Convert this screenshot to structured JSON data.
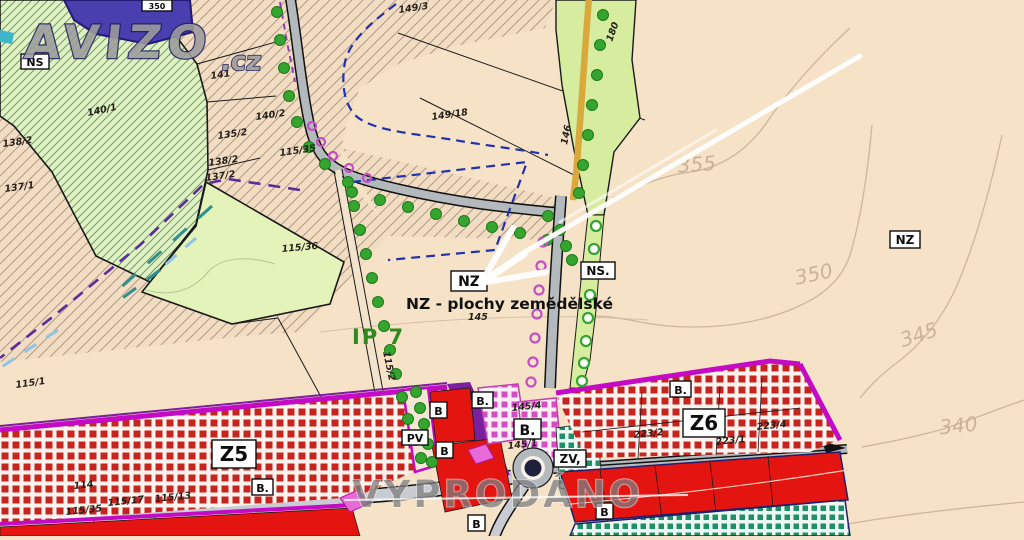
{
  "watermarks": {
    "brand": "AVIZO",
    "brand_suffix": ".cz",
    "sold": "VYPRODÁNO"
  },
  "callout": {
    "zone_code": "NZ",
    "text": "NZ - plochy zemědělské"
  },
  "map_labels": {
    "ns": "NS",
    "nz_right": "NZ",
    "ns_road": "NS.",
    "z5": "Z5",
    "z6": "Z6",
    "pv": "PV",
    "zv": "ZV,",
    "b": "B",
    "b_dot": "B.",
    "ip": "IP 7",
    "blue_parcel": "350"
  },
  "contour_labels": {
    "c355": "355",
    "c350": "350",
    "c345": "345",
    "c340": "340"
  },
  "parcels": [
    {
      "label": "140/1"
    },
    {
      "label": "141"
    },
    {
      "label": "140/2"
    },
    {
      "label": "135/2"
    },
    {
      "label": "149/3"
    },
    {
      "label": "149/18"
    },
    {
      "label": "146"
    },
    {
      "label": "180"
    },
    {
      "label": "138/2"
    },
    {
      "label": "137/1"
    },
    {
      "label": "138/2"
    },
    {
      "label": "137/2"
    },
    {
      "label": "115/35"
    },
    {
      "label": "115/36"
    },
    {
      "label": "115/1"
    },
    {
      "label": "115/2"
    },
    {
      "label": "114"
    },
    {
      "label": "115/35"
    },
    {
      "label": "115/17"
    },
    {
      "label": "115/13"
    },
    {
      "label": "145"
    },
    {
      "label": "145/4"
    },
    {
      "label": "145/1"
    },
    {
      "label": "223/2"
    },
    {
      "label": "223/1"
    },
    {
      "label": "223/4"
    }
  ],
  "colors": {
    "background_beige": "#f6e2c6",
    "zone_green_light": "#d6eda0",
    "zone_green_hatched": "#dff2c4",
    "checker_red": "#c5241f",
    "solid_red": "#e41410",
    "magenta_border": "#c40ac4",
    "purple_band": "#7a1f9e",
    "blue_zone": "#4a3fae",
    "tree_green": "#35a52f",
    "road_grey": "#b4b9be",
    "yellow_road": "#d9a93c",
    "contour_grey": "#cdb69c"
  }
}
